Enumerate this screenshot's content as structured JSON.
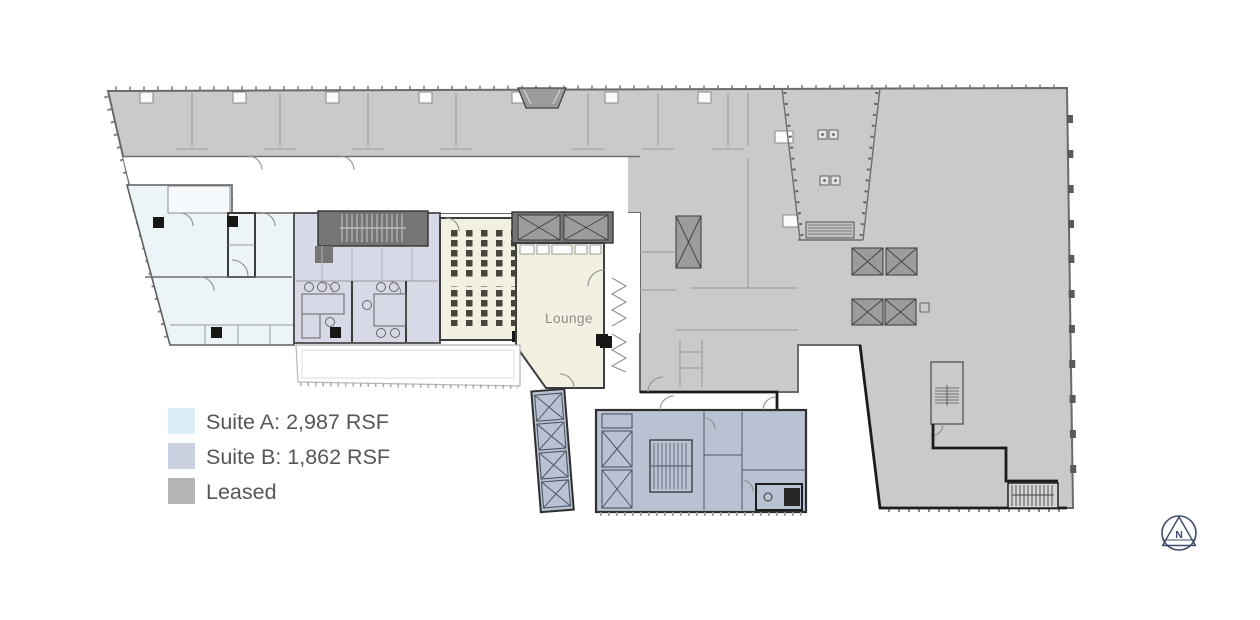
{
  "page": {
    "background": "#ffffff"
  },
  "legend": {
    "items": [
      {
        "id": "suite-a",
        "label": "Suite A: 2,987 RSF",
        "color": "#dceef6"
      },
      {
        "id": "suite-b",
        "label": "Suite B: 1,862 RSF",
        "color": "#ccd1e2"
      },
      {
        "id": "leased",
        "label": "Leased",
        "color": "#b5b5b6"
      }
    ],
    "text_color": "#55565a"
  },
  "plan": {
    "lounge_label": "Lounge",
    "colors": {
      "leased_fill": "#cacaca",
      "suite_a_fill": "#ecf4f8",
      "suite_b_fill": "#d7d9e7",
      "lounge_fill": "#f2f1e1",
      "core_fill": "#b9c2d3",
      "stair_fill": "#757575",
      "wall": "#3c3c3c"
    }
  },
  "compass": {
    "label": "N",
    "color": "#3e4a6b"
  }
}
